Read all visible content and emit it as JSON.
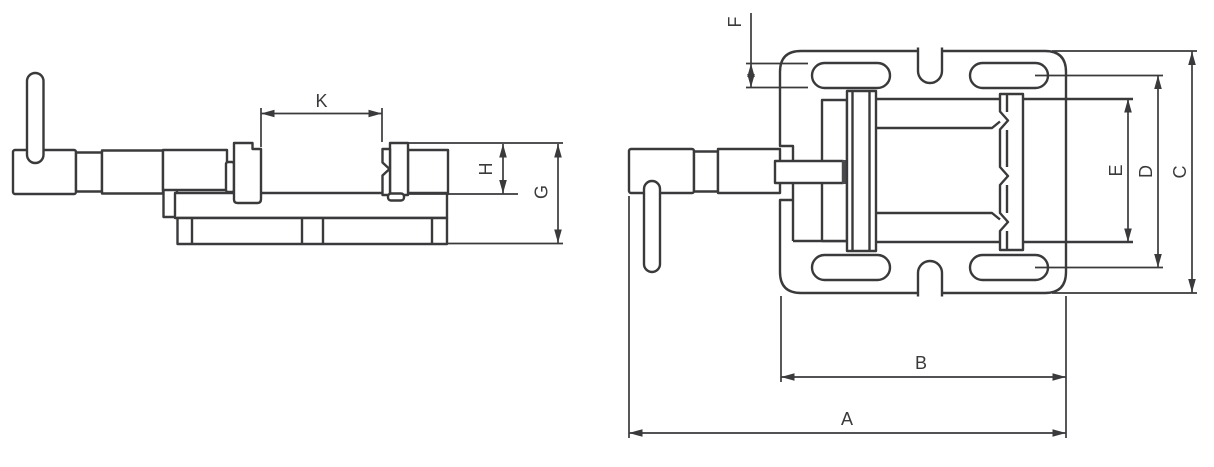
{
  "drawing": {
    "type": "technical-drawing",
    "subject": "drill press machine vise dimensional diagram",
    "views": [
      {
        "id": "side-view",
        "dimension_labels": [
          "K",
          "H",
          "G"
        ]
      },
      {
        "id": "top-view",
        "dimension_labels": [
          "F",
          "E",
          "D",
          "C",
          "B",
          "A"
        ]
      }
    ]
  },
  "labels": {
    "A": "A",
    "B": "B",
    "C": "C",
    "D": "D",
    "E": "E",
    "F": "F",
    "G": "G",
    "H": "H",
    "K": "K"
  },
  "colors": {
    "line": "#3a3a3c",
    "background": "#ffffff"
  }
}
